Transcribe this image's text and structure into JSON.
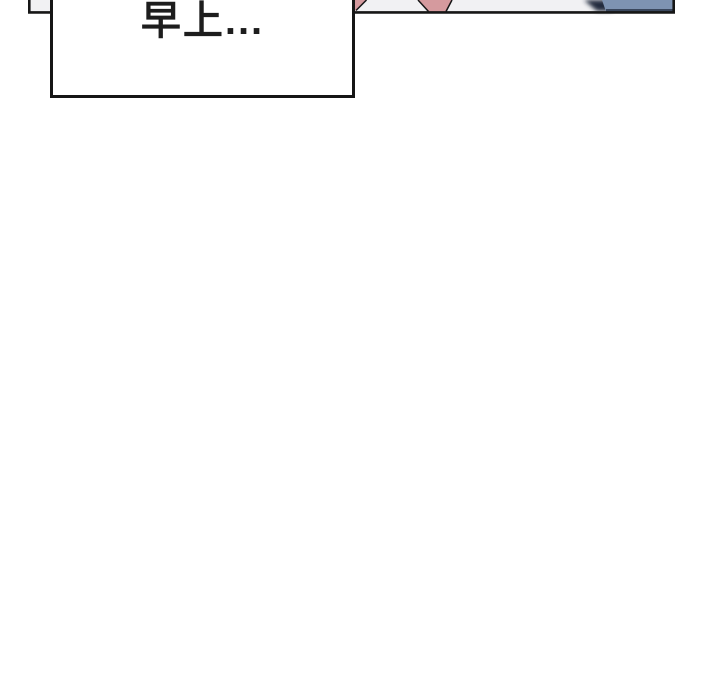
{
  "page": {
    "background": "#ffffff"
  },
  "panel": {
    "description": "bottom sliver of a comic panel, cut off by top of viewport",
    "background": "#f1f1f3",
    "ink": "#161616",
    "shapes": {
      "pink": "#d59a9e",
      "blue": "#7e93b2",
      "blue_shadow": "#2e3a4e",
      "dark_wedge": "#242c3c"
    }
  },
  "bubble": {
    "text": "早上...",
    "background": "#ffffff",
    "text_color": "#1d1d1d"
  }
}
